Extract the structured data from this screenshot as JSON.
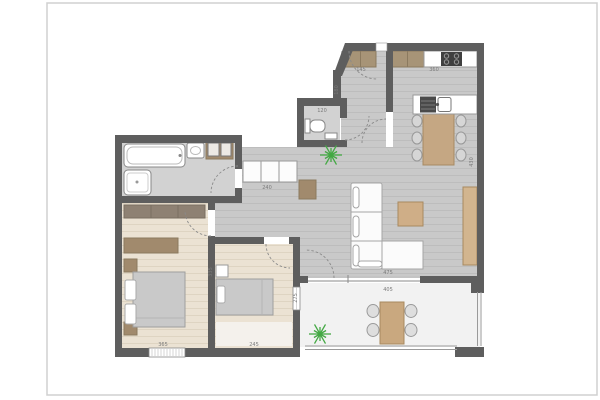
{
  "plan": {
    "type": "apartment-floor-plan",
    "palette": {
      "wall": "#5e5e5e",
      "floor_main": "#c9c9c9",
      "floor_plank_line": "#bdbdbd",
      "floor_wood": "#ebe2d3",
      "floor_wood_line": "#ded4c2",
      "floor_bath": "#d2d2d2",
      "floor_terrace": "#f2f2f2",
      "furniture_wood_light": "#c5a783",
      "furniture_wood_dark": "#a18a6d",
      "wardrobe_gray_brown": "#8e8173",
      "fixture_white": "#ffffff",
      "bed_gray": "#c9c9c9",
      "cooktop_dark": "#3f3f3f",
      "plant_green": "#44a944",
      "outline": "#999999",
      "dim_text": "#7a7a7a",
      "page_border": "#d0d0d0"
    },
    "dimensions": [
      {
        "t": "145",
        "x": 361,
        "y": 71,
        "v": false
      },
      {
        "t": "360",
        "x": 434,
        "y": 71,
        "v": false
      },
      {
        "t": "120",
        "x": 322,
        "y": 112,
        "v": false
      },
      {
        "t": "240",
        "x": 267,
        "y": 189,
        "v": false
      },
      {
        "t": "365",
        "x": 163,
        "y": 346,
        "v": false
      },
      {
        "t": "245",
        "x": 254,
        "y": 346,
        "v": false
      },
      {
        "t": "475",
        "x": 388,
        "y": 274,
        "v": false
      },
      {
        "t": "405",
        "x": 388,
        "y": 291,
        "v": false
      },
      {
        "t": "430",
        "x": 473,
        "y": 162,
        "v": true
      },
      {
        "t": "180",
        "x": 338,
        "y": 90,
        "v": true
      },
      {
        "t": "335",
        "x": 212,
        "y": 272,
        "v": true
      },
      {
        "t": "275",
        "x": 297,
        "y": 298,
        "v": true
      }
    ],
    "inventory": {
      "hall": [
        "entrance-door",
        "closet"
      ],
      "wc": [
        "toilet",
        "hand-basin"
      ],
      "kitchen": [
        "wall-cabinets",
        "counter-with-cooktop",
        "island-with-sink",
        "dining-table",
        "6-chairs"
      ],
      "living": [
        "sofa",
        "coffee-table",
        "sideboard",
        "cabinet",
        "plant"
      ],
      "bathroom": [
        "bathtub",
        "shower",
        "vanity-sink",
        "washer-dryer"
      ],
      "bedroom1": [
        "wardrobe",
        "dresser",
        "double-bed",
        "2-nightstands",
        "window"
      ],
      "bedroom2": [
        "single-bed",
        "nightstand",
        "rug",
        "window"
      ],
      "terrace": [
        "outdoor-table",
        "4-chairs",
        "plant",
        "railing"
      ]
    }
  }
}
